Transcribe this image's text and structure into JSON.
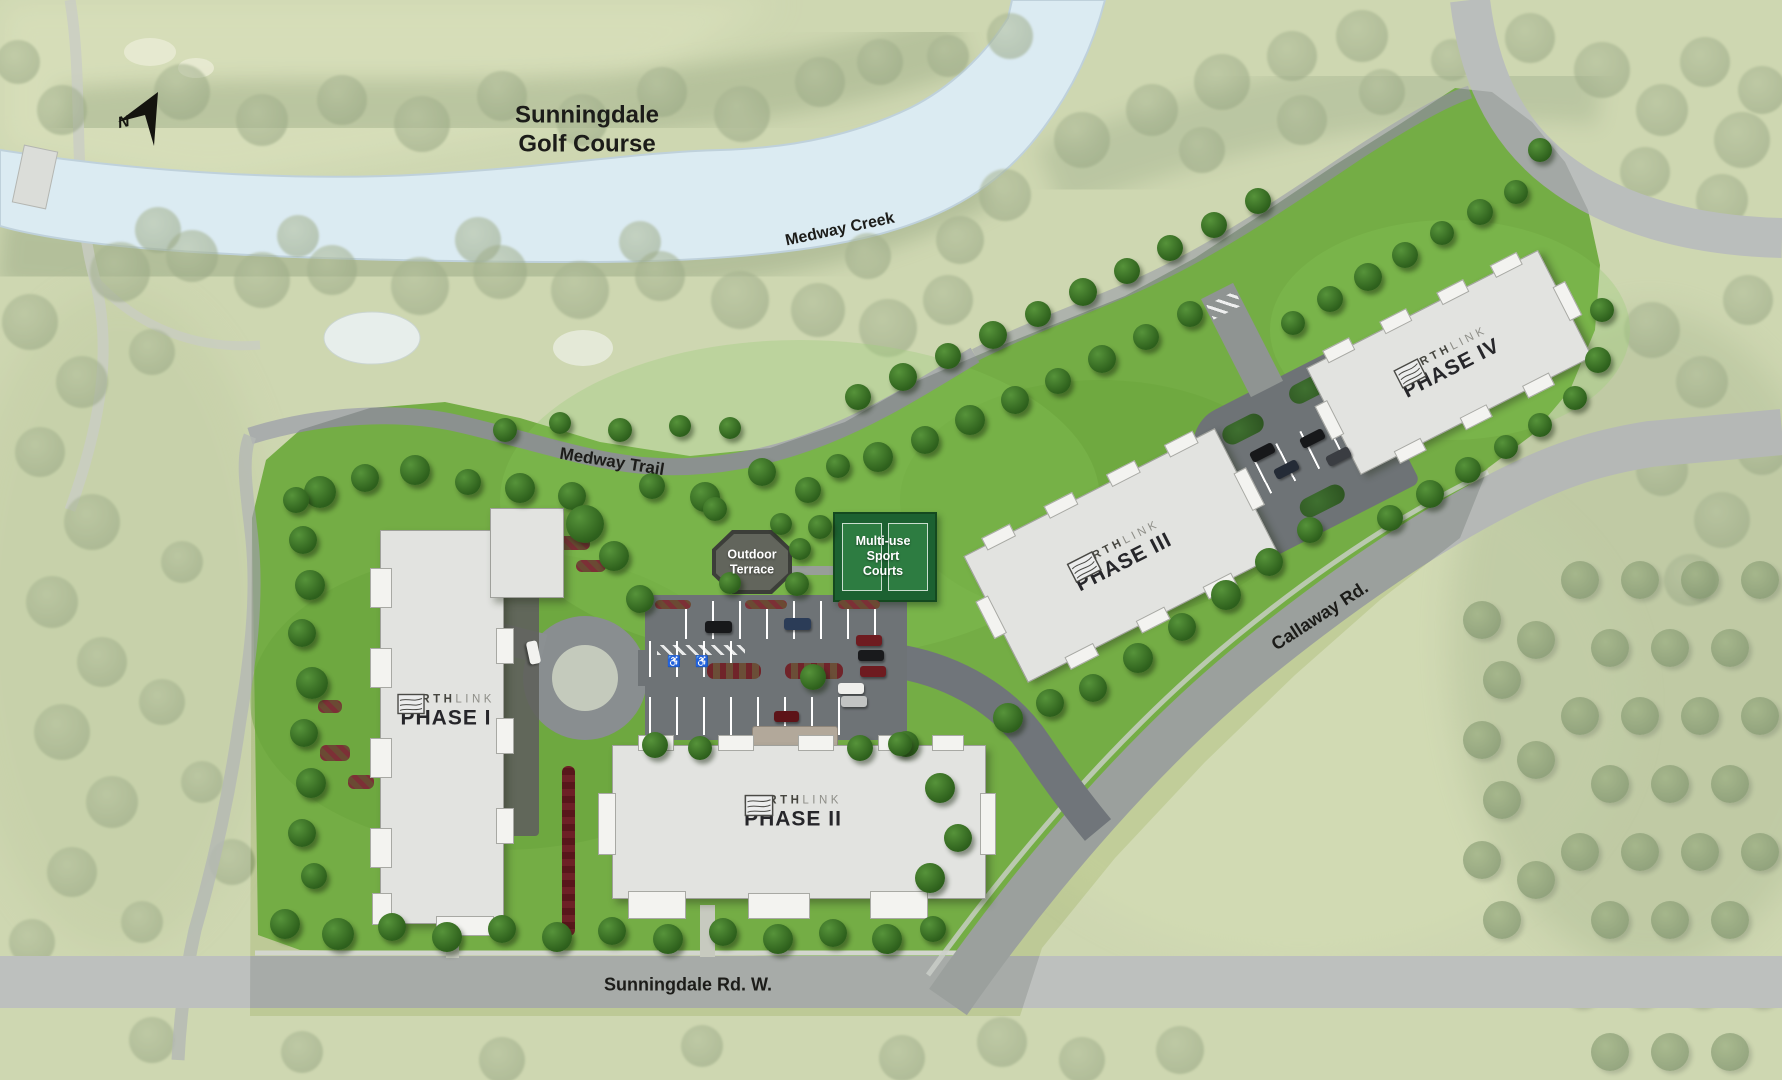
{
  "title": "Northlink site plan",
  "labels": {
    "golf_line1": "Sunningdale",
    "golf_line2": "Golf Course",
    "creek": "Medway Creek",
    "trail": "Medway Trail",
    "callaway": "Callaway Rd.",
    "sunningdale_rd": "Sunningdale Rd. W.",
    "compass_n": "N"
  },
  "brand": {
    "primary": "NORTH",
    "secondary": "LINK"
  },
  "buildings": [
    {
      "phase": "PHASE I"
    },
    {
      "phase": "PHASE II"
    },
    {
      "phase": "PHASE III"
    },
    {
      "phase": "PHASE IV"
    }
  ],
  "amenities": {
    "terrace_line1": "Outdoor",
    "terrace_line2": "Terrace",
    "courts_line1": "Multi-use",
    "courts_line2": "Sport",
    "courts_line3": "Courts"
  },
  "colors": {
    "parcel_green": "#74ad45",
    "creek_blue": "#cfe4ee",
    "road_gray": "#a7aba8",
    "asphalt": "#6e7376",
    "building": "#e2e3e0",
    "courts_green": "#1c6131",
    "label_dark": "#1c1c19"
  },
  "map": {
    "trees_crisp": [
      [
        320,
        492,
        16
      ],
      [
        365,
        478,
        14
      ],
      [
        415,
        470,
        15
      ],
      [
        468,
        482,
        13
      ],
      [
        520,
        488,
        15
      ],
      [
        572,
        496,
        14
      ],
      [
        652,
        486,
        13
      ],
      [
        705,
        497,
        15
      ],
      [
        762,
        472,
        14
      ],
      [
        808,
        490,
        13
      ],
      [
        838,
        466,
        12
      ],
      [
        505,
        430,
        12
      ],
      [
        560,
        423,
        11
      ],
      [
        620,
        430,
        12
      ],
      [
        680,
        426,
        11
      ],
      [
        730,
        428,
        11
      ],
      [
        296,
        500,
        13
      ],
      [
        303,
        540,
        14
      ],
      [
        310,
        585,
        15
      ],
      [
        302,
        633,
        14
      ],
      [
        312,
        683,
        16
      ],
      [
        304,
        733,
        14
      ],
      [
        311,
        783,
        15
      ],
      [
        302,
        833,
        14
      ],
      [
        314,
        876,
        13
      ],
      [
        285,
        924,
        15
      ],
      [
        338,
        934,
        16
      ],
      [
        392,
        927,
        14
      ],
      [
        447,
        937,
        15
      ],
      [
        502,
        929,
        14
      ],
      [
        557,
        937,
        15
      ],
      [
        612,
        931,
        14
      ],
      [
        668,
        939,
        15
      ],
      [
        723,
        932,
        14
      ],
      [
        778,
        939,
        15
      ],
      [
        833,
        933,
        14
      ],
      [
        887,
        939,
        15
      ],
      [
        933,
        929,
        13
      ],
      [
        585,
        524,
        19
      ],
      [
        614,
        556,
        15
      ],
      [
        640,
        599,
        14
      ],
      [
        715,
        509,
        12
      ],
      [
        781,
        524,
        11
      ],
      [
        820,
        527,
        12
      ],
      [
        800,
        549,
        11
      ],
      [
        797,
        584,
        12
      ],
      [
        730,
        583,
        11
      ],
      [
        878,
        457,
        15
      ],
      [
        925,
        440,
        14
      ],
      [
        970,
        420,
        15
      ],
      [
        1015,
        400,
        14
      ],
      [
        1058,
        381,
        13
      ],
      [
        1102,
        359,
        14
      ],
      [
        1146,
        337,
        13
      ],
      [
        1190,
        314,
        13
      ],
      [
        858,
        397,
        13
      ],
      [
        903,
        377,
        14
      ],
      [
        948,
        356,
        13
      ],
      [
        993,
        335,
        14
      ],
      [
        1038,
        314,
        13
      ],
      [
        1083,
        292,
        14
      ],
      [
        1127,
        271,
        13
      ],
      [
        1170,
        248,
        13
      ],
      [
        1214,
        225,
        13
      ],
      [
        1258,
        201,
        13
      ],
      [
        1008,
        718,
        15
      ],
      [
        1050,
        703,
        14
      ],
      [
        1093,
        688,
        14
      ],
      [
        1138,
        658,
        15
      ],
      [
        1182,
        627,
        14
      ],
      [
        1226,
        595,
        15
      ],
      [
        1269,
        562,
        14
      ],
      [
        1310,
        530,
        13
      ],
      [
        940,
        788,
        15
      ],
      [
        958,
        838,
        14
      ],
      [
        930,
        878,
        15
      ],
      [
        906,
        744,
        13
      ],
      [
        655,
        745,
        13
      ],
      [
        700,
        748,
        12
      ],
      [
        860,
        748,
        13
      ],
      [
        900,
        744,
        12
      ],
      [
        813,
        677,
        13
      ],
      [
        1293,
        323,
        12
      ],
      [
        1330,
        299,
        13
      ],
      [
        1368,
        277,
        14
      ],
      [
        1405,
        255,
        13
      ],
      [
        1442,
        233,
        12
      ],
      [
        1480,
        212,
        13
      ],
      [
        1516,
        192,
        12
      ],
      [
        1540,
        150,
        12
      ],
      [
        1390,
        518,
        13
      ],
      [
        1430,
        494,
        14
      ],
      [
        1468,
        470,
        13
      ],
      [
        1506,
        447,
        12
      ],
      [
        1540,
        425,
        12
      ],
      [
        1575,
        398,
        12
      ],
      [
        1598,
        360,
        13
      ],
      [
        1602,
        310,
        12
      ]
    ],
    "trees_washed": [
      [
        120,
        272,
        30
      ],
      [
        192,
        256,
        26
      ],
      [
        262,
        280,
        28
      ],
      [
        332,
        270,
        25
      ],
      [
        420,
        286,
        29
      ],
      [
        500,
        272,
        27
      ],
      [
        580,
        290,
        29
      ],
      [
        660,
        276,
        25
      ],
      [
        740,
        300,
        29
      ],
      [
        818,
        310,
        27
      ],
      [
        888,
        328,
        29
      ],
      [
        948,
        300,
        25
      ],
      [
        868,
        256,
        23
      ],
      [
        640,
        242,
        21
      ],
      [
        478,
        240,
        23
      ],
      [
        298,
        236,
        21
      ],
      [
        158,
        230,
        23
      ],
      [
        960,
        240,
        24
      ],
      [
        1005,
        195,
        26
      ],
      [
        182,
        92,
        28
      ],
      [
        262,
        120,
        26
      ],
      [
        342,
        100,
        25
      ],
      [
        422,
        124,
        28
      ],
      [
        502,
        96,
        25
      ],
      [
        582,
        120,
        26
      ],
      [
        662,
        92,
        25
      ],
      [
        742,
        114,
        28
      ],
      [
        820,
        82,
        25
      ],
      [
        880,
        62,
        23
      ],
      [
        948,
        56,
        21
      ],
      [
        1010,
        36,
        23
      ],
      [
        62,
        110,
        25
      ],
      [
        18,
        62,
        22
      ],
      [
        1082,
        140,
        28
      ],
      [
        1152,
        110,
        26
      ],
      [
        1222,
        82,
        28
      ],
      [
        1292,
        56,
        25
      ],
      [
        1362,
        36,
        26
      ],
      [
        1202,
        150,
        23
      ],
      [
        1302,
        120,
        25
      ],
      [
        1382,
        92,
        23
      ],
      [
        1452,
        60,
        21
      ],
      [
        1530,
        38,
        25
      ],
      [
        1602,
        70,
        28
      ],
      [
        1662,
        110,
        26
      ],
      [
        1705,
        62,
        25
      ],
      [
        1742,
        140,
        28
      ],
      [
        1645,
        172,
        25
      ],
      [
        1722,
        200,
        26
      ],
      [
        1762,
        90,
        24
      ],
      [
        1652,
        330,
        28
      ],
      [
        1702,
        382,
        26
      ],
      [
        1748,
        300,
        25
      ],
      [
        1662,
        470,
        26
      ],
      [
        1722,
        520,
        28
      ],
      [
        1762,
        450,
        25
      ],
      [
        1690,
        580,
        26
      ],
      [
        30,
        322,
        28
      ],
      [
        82,
        382,
        26
      ],
      [
        40,
        452,
        25
      ],
      [
        92,
        522,
        28
      ],
      [
        52,
        602,
        26
      ],
      [
        102,
        662,
        25
      ],
      [
        62,
        732,
        28
      ],
      [
        112,
        802,
        26
      ],
      [
        72,
        872,
        25
      ],
      [
        32,
        942,
        23
      ],
      [
        152,
        352,
        23
      ],
      [
        182,
        562,
        21
      ],
      [
        162,
        702,
        23
      ],
      [
        202,
        782,
        21
      ],
      [
        232,
        862,
        23
      ],
      [
        142,
        922,
        21
      ],
      [
        1002,
        1042,
        25
      ],
      [
        1082,
        1060,
        23
      ],
      [
        302,
        1052,
        21
      ],
      [
        502,
        1060,
        23
      ],
      [
        702,
        1046,
        21
      ],
      [
        152,
        1040,
        23
      ],
      [
        902,
        1058,
        23
      ],
      [
        1180,
        1050,
        24
      ]
    ],
    "orchard": [
      [
        1580,
        580
      ],
      [
        1640,
        580
      ],
      [
        1700,
        580
      ],
      [
        1760,
        580
      ],
      [
        1610,
        648
      ],
      [
        1670,
        648
      ],
      [
        1730,
        648
      ],
      [
        1580,
        716
      ],
      [
        1640,
        716
      ],
      [
        1700,
        716
      ],
      [
        1760,
        716
      ],
      [
        1610,
        784
      ],
      [
        1670,
        784
      ],
      [
        1730,
        784
      ],
      [
        1580,
        852
      ],
      [
        1640,
        852
      ],
      [
        1700,
        852
      ],
      [
        1760,
        852
      ],
      [
        1610,
        920
      ],
      [
        1670,
        920
      ],
      [
        1730,
        920
      ],
      [
        1580,
        988
      ],
      [
        1640,
        988
      ],
      [
        1700,
        988
      ],
      [
        1760,
        988
      ],
      [
        1610,
        1052
      ],
      [
        1670,
        1052
      ],
      [
        1730,
        1052
      ],
      [
        1482,
        620
      ],
      [
        1502,
        680
      ],
      [
        1482,
        740
      ],
      [
        1502,
        800
      ],
      [
        1482,
        860
      ],
      [
        1502,
        920
      ],
      [
        1536,
        640
      ],
      [
        1536,
        760
      ],
      [
        1536,
        880
      ]
    ],
    "cars": [
      [
        718,
        627,
        27,
        12,
        "#17181a",
        0
      ],
      [
        797,
        624,
        27,
        12,
        "#2b3c57",
        0
      ],
      [
        869,
        640,
        26,
        11,
        "#6e1b20",
        0
      ],
      [
        871,
        655,
        26,
        11,
        "#191a1c",
        0
      ],
      [
        873,
        671,
        26,
        11,
        "#6e1b20",
        0
      ],
      [
        851,
        688,
        26,
        11,
        "#efefec",
        0
      ],
      [
        854,
        701,
        26,
        11,
        "#c2c4c3",
        0
      ],
      [
        786,
        716,
        25,
        11,
        "#5d1318",
        0
      ],
      [
        533,
        652,
        23,
        11,
        "#f2f2ef",
        78
      ],
      [
        1262,
        452,
        25,
        11,
        "#17181a",
        -27
      ],
      [
        1286,
        469,
        25,
        11,
        "#242b36",
        -27
      ],
      [
        1312,
        438,
        25,
        11,
        "#17181a",
        -27
      ],
      [
        1338,
        456,
        25,
        11,
        "#3a3d42",
        -27
      ]
    ],
    "beds": [
      [
        320,
        745,
        30,
        16
      ],
      [
        348,
        775,
        26,
        14
      ],
      [
        318,
        700,
        24,
        13
      ],
      [
        556,
        536,
        34,
        14
      ],
      [
        576,
        560,
        30,
        12
      ],
      [
        655,
        600,
        36,
        9
      ],
      [
        745,
        600,
        42,
        9
      ],
      [
        838,
        600,
        42,
        9
      ]
    ]
  }
}
